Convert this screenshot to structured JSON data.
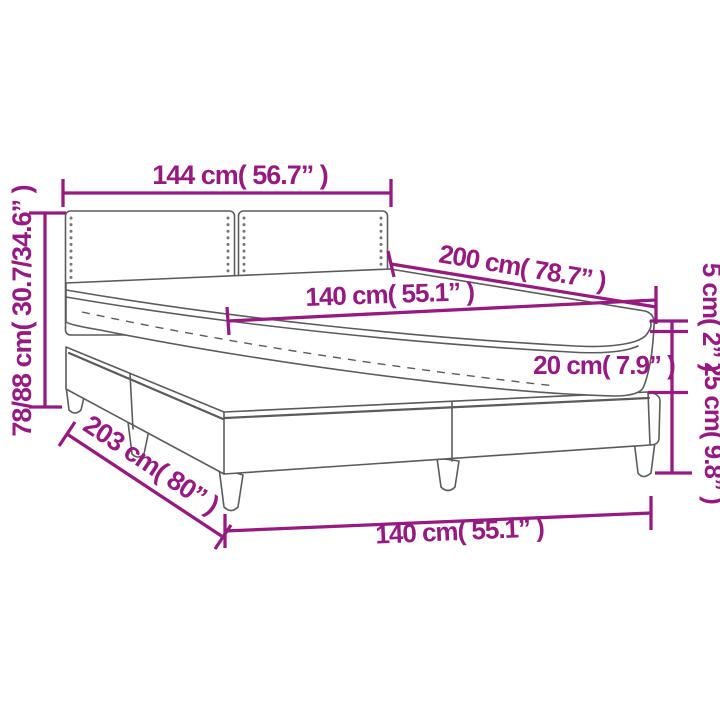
{
  "diagram": {
    "description": "Box spring bed with headboard and mattress - dimension drawing",
    "colors": {
      "accent": "#951b81",
      "line_art": "#5b5b5e",
      "background": "#ffffff"
    },
    "labels": {
      "headboard_width": "144 cm( 56.7” )",
      "total_height": "78/88 cm( 30.7/34.6” )",
      "mattress_length": "200 cm( 78.7” )",
      "mattress_width_top": "140 cm( 55.1” )",
      "topper_height": "5 cm( 2” )",
      "mattress_height": "20 cm( 7.9” )",
      "base_height": "25 cm( 9.8” )",
      "base_length": "203 cm( 80” )",
      "base_width_bottom": "140 cm( 55.1” )"
    }
  }
}
